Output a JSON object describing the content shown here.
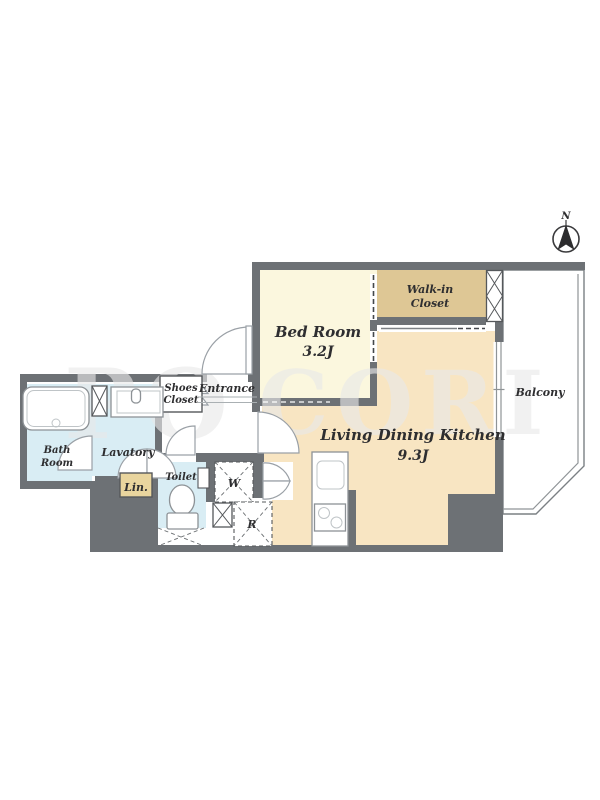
{
  "compass": {
    "north": "N"
  },
  "rooms": {
    "bed_room": {
      "name": "Bed Room",
      "size": "3.2J"
    },
    "walk_in_closet": {
      "line1": "Walk-in",
      "line2": "Closet"
    },
    "ldk": {
      "name": "Living Dining Kitchen",
      "size": "9.3J"
    },
    "balcony": {
      "name": "Balcony"
    },
    "bath_room": {
      "line1": "Bath",
      "line2": "Room"
    },
    "lavatory": {
      "name": "Lavatory"
    },
    "linen": {
      "name": "Lin."
    },
    "toilet": {
      "name": "Toilet"
    },
    "shoes_closet": {
      "line1": "Shoes",
      "line2": "Closet"
    },
    "entrance": {
      "name": "Entrance"
    }
  },
  "marks": {
    "washer": "W",
    "refrigerator": "R"
  },
  "watermark": {
    "left": "PO",
    "right": "CORI"
  },
  "colors": {
    "wall": "#6d7175",
    "bedroom_floor": "#fbf7de",
    "closet_floor": "#dec795",
    "ldk_floor": "#f8e5c2",
    "wet_area_floor": "#d9edf4",
    "linen_floor": "#e9d59e",
    "balcony_floor": "#ffffff",
    "line": "#8f9497"
  }
}
